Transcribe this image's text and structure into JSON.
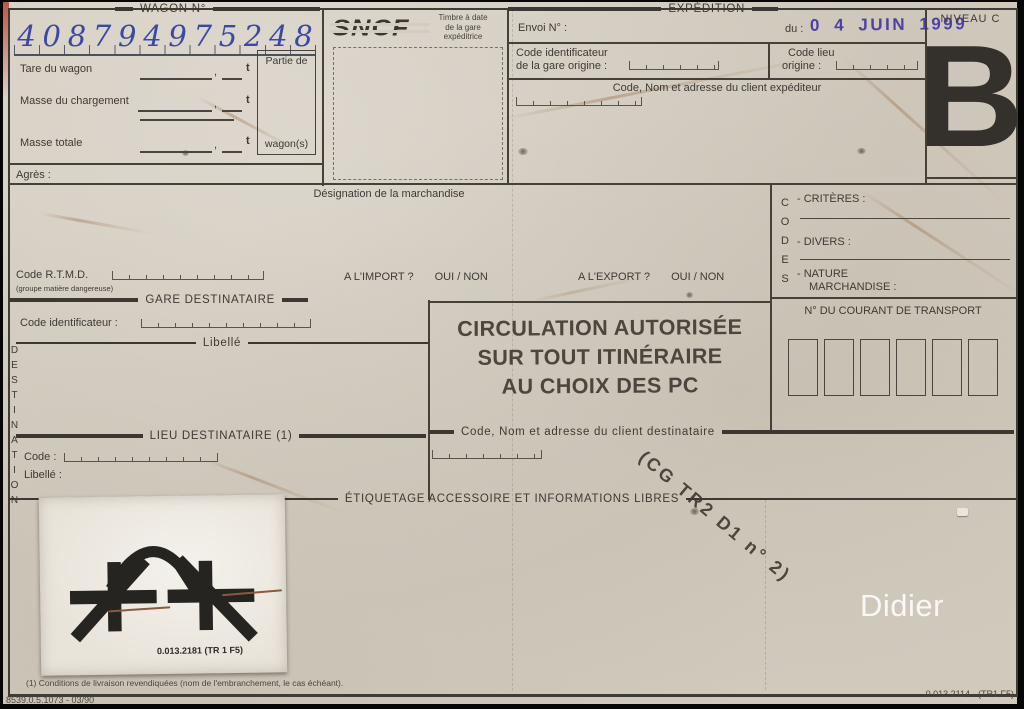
{
  "form": {
    "wagon": {
      "header": "WAGON N°",
      "digits": [
        "4",
        "0",
        "8",
        "7",
        "9",
        "4",
        "9",
        "7",
        "5",
        "2",
        "4",
        "8"
      ],
      "tare_label": "Tare du wagon",
      "charge_label": "Masse du chargement",
      "totale_label": "Masse totale",
      "unit": "t",
      "comma": ",",
      "partie_de": "Partie de",
      "wagons": "wagon(s)",
      "agres": "Agrès :"
    },
    "sncf": {
      "logo": "SNCF",
      "timbre_l1": "Timbre à date",
      "timbre_l2": "de la gare",
      "timbre_l3": "expéditrice"
    },
    "expedition": {
      "header": "EXPÉDITION",
      "envoi": "Envoi N° :",
      "du": "du :",
      "date_stamp": "0 4 JUIN 1999",
      "code_ident_l1": "Code identificateur",
      "code_ident_l2": "de la gare origine :",
      "code_lieu_l1": "Code lieu",
      "code_lieu_l2": "origine :",
      "client": "Code, Nom et adresse du client expéditeur"
    },
    "niveau": {
      "label": "NIVEAU C",
      "letter": "B"
    },
    "marchandise": {
      "designation": "Désignation de la marchandise",
      "rtmd": "Code R.T.M.D.",
      "rtmd_note": "(groupe matière dangereuse)",
      "import_q": "A L'IMPORT ?",
      "export_q": "A L'EXPORT ?",
      "oui_non": "OUI / NON"
    },
    "codes": {
      "vertical": "CODES",
      "criteres": "- CRITÈRES :",
      "divers": "- DIVERS :",
      "nature_l1": "- NATURE",
      "nature_l2": "MARCHANDISE :"
    },
    "destination": {
      "vertical": "DESTINATION",
      "gare_header": "GARE DESTINATAIRE",
      "code_ident": "Code identificateur :",
      "libelle_header": "Libellé",
      "lieu_header": "LIEU DESTINATAIRE (1)",
      "code": "Code :",
      "libelle": "Libellé :"
    },
    "circulation": {
      "l1": "CIRCULATION AUTORISÉE",
      "l2": "SUR TOUT  ITINÉRAIRE",
      "l3": "AU CHOIX DES PC"
    },
    "courant": {
      "title": "N° DU COURANT DE TRANSPORT"
    },
    "client_dest": {
      "header": "Code, Nom et adresse du client destinataire",
      "stamp": "(CG TR2 D1 n° 2)"
    },
    "etiquetage": {
      "header": "ÉTIQUETAGE ACCESSOIRE ET INFORMATIONS LIBRES"
    },
    "sticker": {
      "ref": "0.013.2181  (TR 1 F5)"
    },
    "footer": {
      "note": "(1)  Conditions de livraison revendiquées (nom de l'embranchement, le cas échéant).",
      "ref_left": "8539.0.5.1073 - 03/90",
      "ref_right": "0.013.2114 - (TR1 F5)",
      "watermark": "Didier"
    }
  },
  "colors": {
    "paper": "#d3ccc0",
    "ink": "#3e3a34",
    "pen_blue": "#3a49a2",
    "stamp_violet": "#4e41a4",
    "big_letter": "#34302b"
  }
}
